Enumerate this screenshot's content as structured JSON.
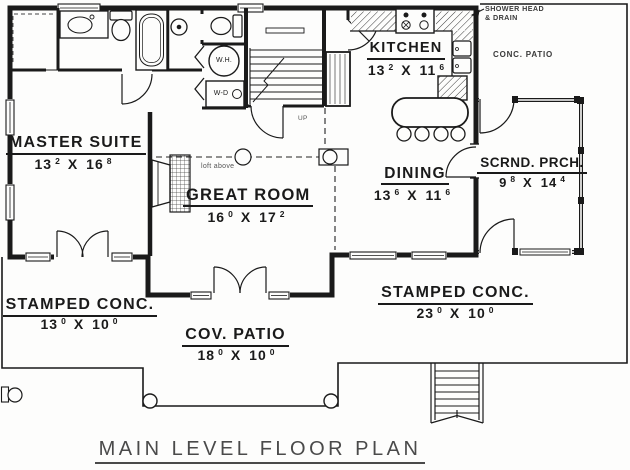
{
  "title": "MAIN LEVEL FLOOR PLAN",
  "colors": {
    "line": "#1a1a1a",
    "bg": "#fdfdfc",
    "title_text": "#4a4a4a",
    "muted_text": "#3a3a3a"
  },
  "rooms": {
    "master_suite": {
      "name": "MASTER SUITE",
      "dim": {
        "a": "13",
        "as": "2",
        "sep": "X",
        "b": "16",
        "bs": "8"
      }
    },
    "great_room": {
      "name": "GREAT ROOM",
      "dim": {
        "a": "16",
        "as": "0",
        "sep": "X",
        "b": "17",
        "bs": "2"
      }
    },
    "kitchen": {
      "name": "KITCHEN",
      "dim": {
        "a": "13",
        "as": "2",
        "sep": "X",
        "b": "11",
        "bs": "6"
      }
    },
    "dining": {
      "name": "DINING",
      "dim": {
        "a": "13",
        "as": "6",
        "sep": "X",
        "b": "11",
        "bs": "6"
      }
    },
    "screened_porch": {
      "name": "SCRND. PRCH.",
      "dim": {
        "a": "9",
        "as": "8",
        "sep": "X",
        "b": "14",
        "bs": "4"
      }
    },
    "stamped_conc_left": {
      "name": "STAMPED CONC.",
      "dim": {
        "a": "13",
        "as": "0",
        "sep": "X",
        "b": "10",
        "bs": "0"
      }
    },
    "cov_patio": {
      "name": "COV. PATIO",
      "dim": {
        "a": "18",
        "as": "0",
        "sep": "X",
        "b": "10",
        "bs": "0"
      }
    },
    "stamped_conc_right": {
      "name": "STAMPED CONC.",
      "dim": {
        "a": "23",
        "as": "0",
        "sep": "X",
        "b": "10",
        "bs": "0"
      }
    },
    "conc_patio": {
      "name": "CONC. PATIO"
    }
  },
  "annotations": {
    "shower_head_line1": "SHOWER HEAD",
    "shower_head_line2": "& DRAIN",
    "loft_above": "loft above",
    "up": "UP",
    "water_heater": "W.H.",
    "washer_dryer": "W-D"
  }
}
